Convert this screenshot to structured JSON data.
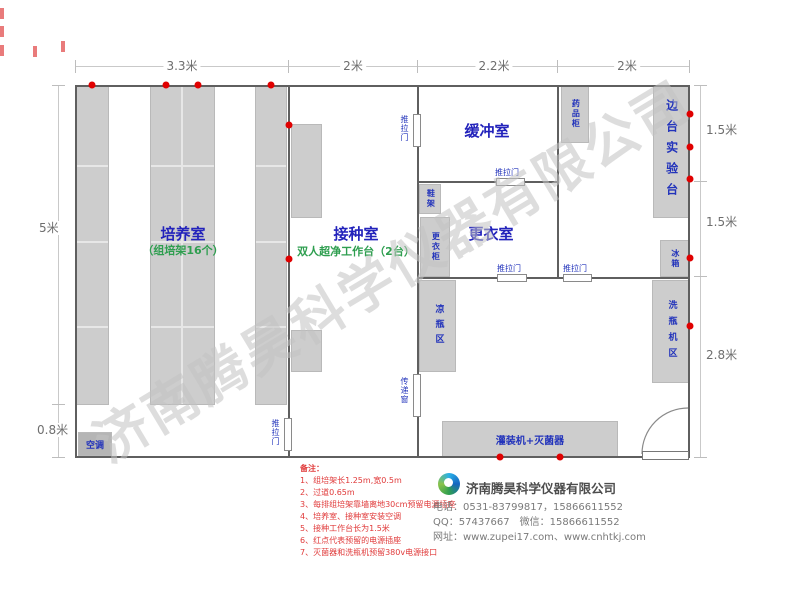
{
  "watermark": "济南腾昊科学仪器有限公司",
  "dimensions": {
    "top": [
      "3.3米",
      "2米",
      "2.2米",
      "2米"
    ],
    "left": [
      "5米",
      "0.8米"
    ],
    "right": [
      "1.5米",
      "1.5米",
      "2.8米"
    ]
  },
  "rooms": {
    "cultivation": {
      "name": "培养室",
      "sub": "（组培架16个）"
    },
    "inoculation": {
      "name": "接种室",
      "sub": "双人超净工作台（2台）"
    },
    "buffer": {
      "name": "缓冲室"
    },
    "changing": {
      "name": "更衣室"
    }
  },
  "furniture": {
    "air_conditioner": "空调",
    "shoe_rack": "鞋架",
    "wardrobe": "更衣柜",
    "cooling_bottle_area": "凉瓶区",
    "medicine_cabinet": "药品柜",
    "side_bench": "边台实验台",
    "fridge": "冰箱",
    "bottle_washer_area": "洗瓶机区",
    "filling_machine": "灌装机+灭菌器"
  },
  "doors": {
    "sliding_door": "推拉门",
    "transfer_window": "传递窗"
  },
  "notes": {
    "title": "备注：",
    "items": [
      "1、组培架长1.25m,宽0.5m",
      "2、过道0.65m",
      "3、每排组培架靠墙离地30cm预留电源插座",
      "4、培养室、接种室安装空调",
      "5、接种工作台长为1.5米",
      "6、红点代表预留的电源插座",
      "7、灭菌器和洗瓶机预留380v电源接口"
    ]
  },
  "company": {
    "name": "济南腾昊科学仪器有限公司",
    "phone": "电话：0531-83799817，15866611552",
    "qq": "QQ：57437667　微信：15866611552",
    "web": "网址：www.zupei17.com、www.cnhtkj.com"
  },
  "colors": {
    "room_label": "#2222bb",
    "sub_label": "#2e9e4f",
    "outlet_dot": "#e00000",
    "wall": "#5f5f5f",
    "furniture": "#cdcdcd"
  }
}
